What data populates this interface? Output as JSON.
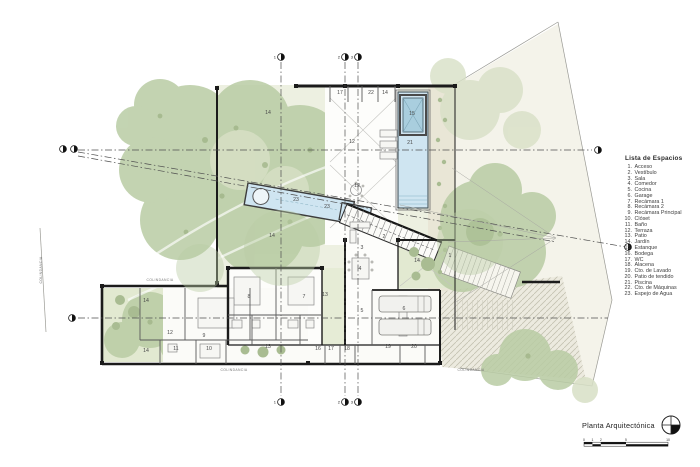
{
  "legend": {
    "title": "Lista de Espacios",
    "items": [
      {
        "num": "1.",
        "name": "Acceso"
      },
      {
        "num": "2.",
        "name": "Vestíbulo"
      },
      {
        "num": "3.",
        "name": "Sala"
      },
      {
        "num": "4.",
        "name": "Comedor"
      },
      {
        "num": "5.",
        "name": "Cocina"
      },
      {
        "num": "6.",
        "name": "Garage"
      },
      {
        "num": "7.",
        "name": "Recámara 1"
      },
      {
        "num": "8.",
        "name": "Recámara 2"
      },
      {
        "num": "9.",
        "name": "Recámara Principal"
      },
      {
        "num": "10.",
        "name": "Clóset"
      },
      {
        "num": "11.",
        "name": "Baño"
      },
      {
        "num": "12.",
        "name": "Terraza"
      },
      {
        "num": "13.",
        "name": "Patio"
      },
      {
        "num": "14.",
        "name": "Jardín"
      },
      {
        "num": "15.",
        "name": "Estanque"
      },
      {
        "num": "16.",
        "name": "Bodega"
      },
      {
        "num": "17.",
        "name": "WC"
      },
      {
        "num": "18.",
        "name": "Alacena"
      },
      {
        "num": "19.",
        "name": "Cto. de Lavado"
      },
      {
        "num": "20.",
        "name": "Patio de tendido"
      },
      {
        "num": "21.",
        "name": "Piscina"
      },
      {
        "num": "22.",
        "name": "Cto. de Máquinas"
      },
      {
        "num": "23.",
        "name": "Espejo de Agua"
      }
    ]
  },
  "titleblock": {
    "title": "Planta Arquitectónica",
    "north_icon": "north-indicator",
    "scale_labels": [
      "0",
      "1",
      "2",
      "5",
      "10"
    ]
  },
  "plan": {
    "room_labels": [
      {
        "n": "17",
        "x": 340,
        "y": 94
      },
      {
        "n": "22",
        "x": 371,
        "y": 94
      },
      {
        "n": "14",
        "x": 385,
        "y": 94
      },
      {
        "n": "15",
        "x": 412,
        "y": 115
      },
      {
        "n": "21",
        "x": 410,
        "y": 144
      },
      {
        "n": "14",
        "x": 268,
        "y": 114
      },
      {
        "n": "12",
        "x": 352,
        "y": 143
      },
      {
        "n": "14",
        "x": 272,
        "y": 237
      },
      {
        "n": "23",
        "x": 296,
        "y": 201
      },
      {
        "n": "23",
        "x": 327,
        "y": 208
      },
      {
        "n": "12",
        "x": 357,
        "y": 187
      },
      {
        "n": "2",
        "x": 384,
        "y": 238
      },
      {
        "n": "1",
        "x": 450,
        "y": 257
      },
      {
        "n": "3",
        "x": 362,
        "y": 249
      },
      {
        "n": "4",
        "x": 360,
        "y": 270
      },
      {
        "n": "13",
        "x": 325,
        "y": 296
      },
      {
        "n": "8",
        "x": 249,
        "y": 298
      },
      {
        "n": "7",
        "x": 304,
        "y": 298
      },
      {
        "n": "5",
        "x": 362,
        "y": 312
      },
      {
        "n": "6",
        "x": 404,
        "y": 310
      },
      {
        "n": "14",
        "x": 417,
        "y": 262
      },
      {
        "n": "14",
        "x": 146,
        "y": 302
      },
      {
        "n": "14",
        "x": 146,
        "y": 352
      },
      {
        "n": "12",
        "x": 170,
        "y": 334
      },
      {
        "n": "11",
        "x": 176,
        "y": 350
      },
      {
        "n": "9",
        "x": 204,
        "y": 337
      },
      {
        "n": "10",
        "x": 209,
        "y": 350
      },
      {
        "n": "13",
        "x": 268,
        "y": 348
      },
      {
        "n": "16",
        "x": 318,
        "y": 350
      },
      {
        "n": "17",
        "x": 331,
        "y": 350
      },
      {
        "n": "18",
        "x": 347,
        "y": 350
      },
      {
        "n": "19",
        "x": 388,
        "y": 348
      },
      {
        "n": "20",
        "x": 414,
        "y": 348
      }
    ],
    "axis_markers": [
      {
        "label": "1",
        "x": 281,
        "y": 57
      },
      {
        "label": "2",
        "x": 345,
        "y": 57
      },
      {
        "label": "3",
        "x": 358,
        "y": 57
      },
      {
        "label": "1",
        "x": 281,
        "y": 402
      },
      {
        "label": "2",
        "x": 345,
        "y": 402
      },
      {
        "label": "3",
        "x": 358,
        "y": 402
      },
      {
        "label": "",
        "x": 63,
        "y": 149
      },
      {
        "label": "",
        "x": 74,
        "y": 149
      },
      {
        "label": "",
        "x": 598,
        "y": 150
      },
      {
        "label": "",
        "x": 72,
        "y": 318
      },
      {
        "label": "",
        "x": 628,
        "y": 247
      }
    ],
    "boundary_labels": [
      {
        "text": "COLINDANCIA",
        "x": 160,
        "y": 281,
        "rotate": 0
      },
      {
        "text": "COLINDANCIA",
        "x": 234,
        "y": 371,
        "rotate": 0
      },
      {
        "text": "COLINDANCIA",
        "x": 471,
        "y": 371,
        "rotate": 0
      },
      {
        "text": "COLINDANCIA",
        "x": 42,
        "y": 270,
        "rotate": -90
      }
    ]
  },
  "colors": {
    "wall": "#1b1b1b",
    "water": "#cfe5f1",
    "water_dark": "#a9cede",
    "foliage": "#b9cca4",
    "foliage_dark": "#9cb183",
    "foliage_light": "#d8e0c6",
    "ground": "#edf0e1",
    "path": "#e9e6d6"
  }
}
